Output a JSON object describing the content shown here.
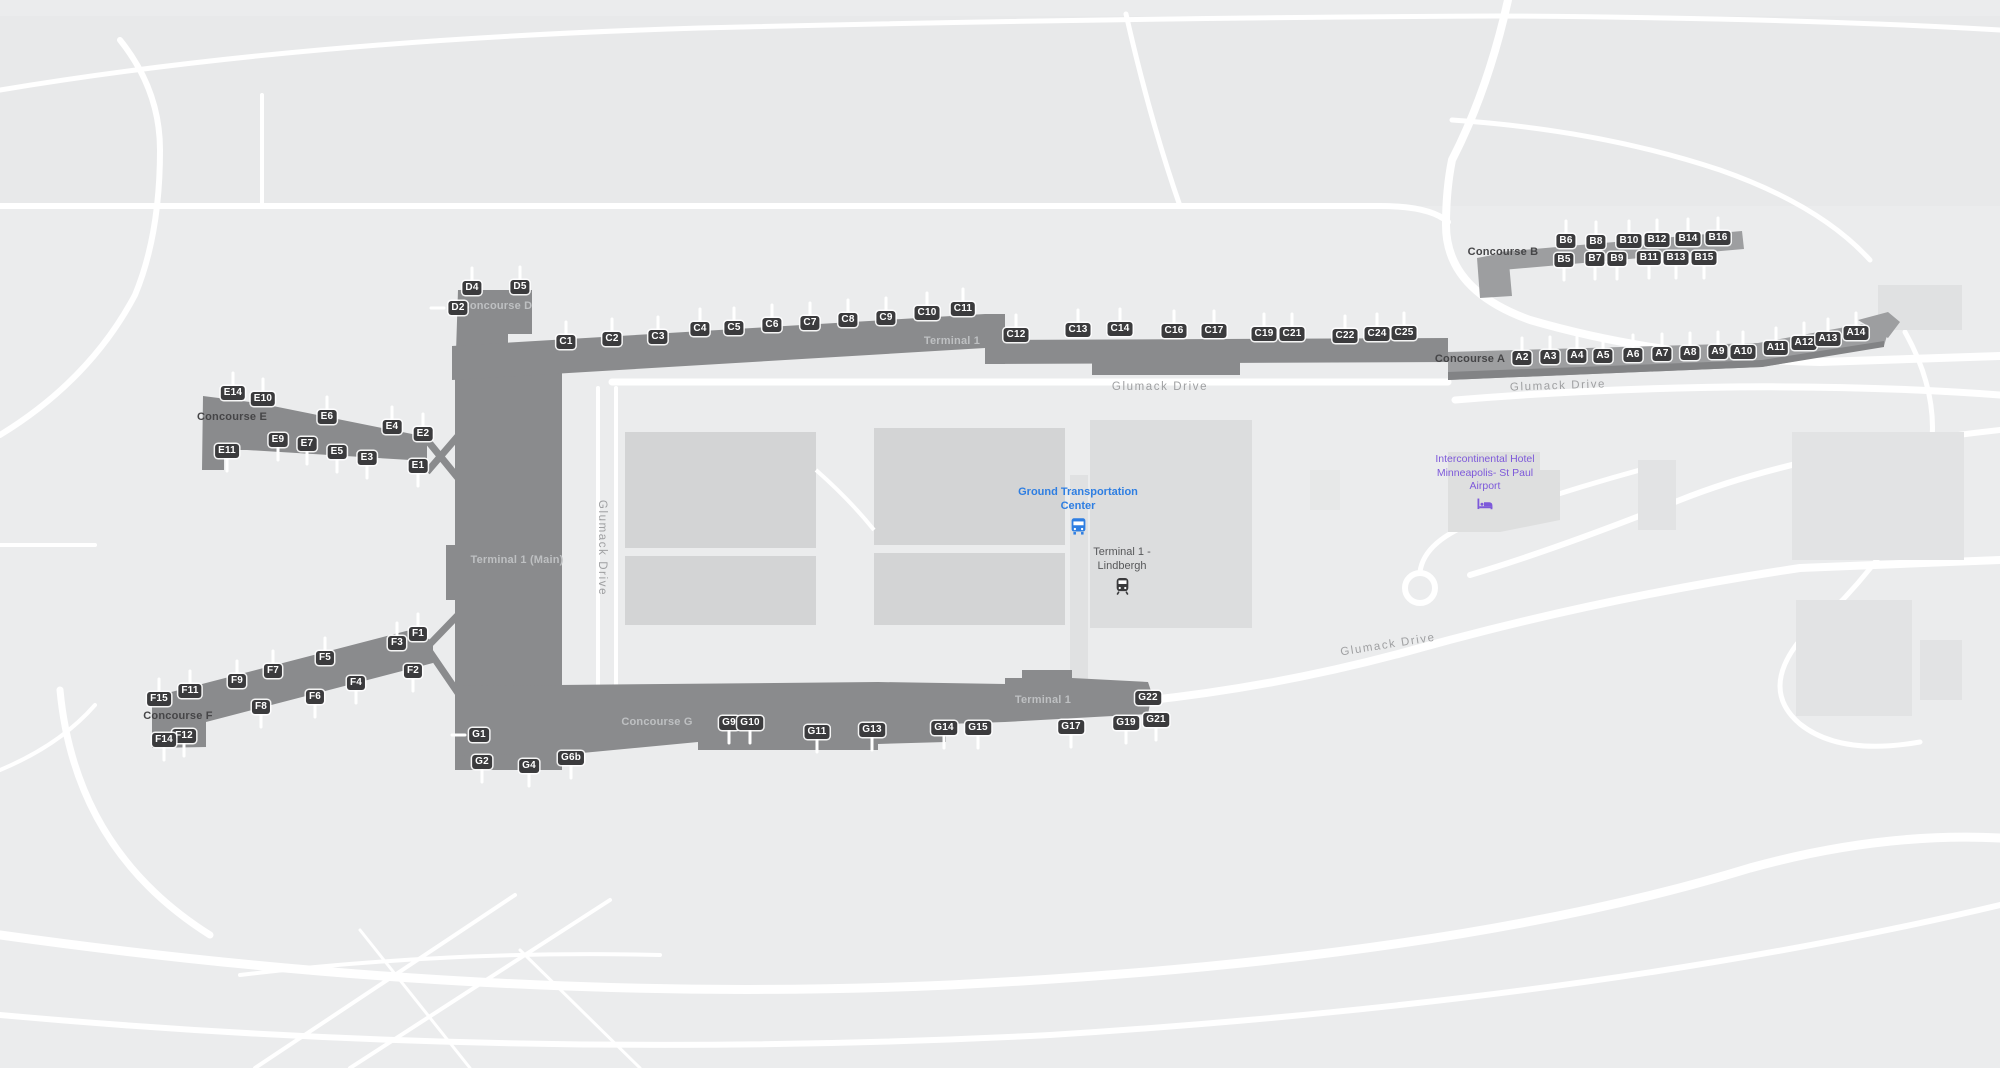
{
  "map": {
    "colors": {
      "background": "#ebeced",
      "road": "#ffffff",
      "building_dark": "#8a8b8d",
      "building_light": "#9d9ea0",
      "parking": "#d3d4d5",
      "parking_light": "#dcddde",
      "badge_bg": "#3b3b3d",
      "badge_text": "#ffffff",
      "label_dark": "#454547",
      "label_light": "#bec0c2",
      "road_label": "#9fa0a2",
      "transit_blue": "#2e7ee2",
      "hotel_purple": "#7d59da"
    }
  },
  "poi": {
    "ground_transport": "Ground Transportation Center",
    "terminal_station": "Terminal 1 - Lindbergh",
    "hotel": "Intercontinental Hotel Minneapolis- St Paul Airport"
  },
  "icons": {
    "bus": "bus-icon",
    "train": "train-icon",
    "bed": "hotel-bed-icon"
  },
  "terminal_labels": [
    {
      "text": "Terminal 1",
      "x": 952,
      "y": 341,
      "style": "light"
    },
    {
      "text": "Terminal 1 (Main)",
      "x": 517,
      "y": 560,
      "style": "light"
    },
    {
      "text": "Terminal 1",
      "x": 1043,
      "y": 700,
      "style": "light"
    }
  ],
  "road_labels": [
    {
      "text": "Glumack Drive",
      "x": 1160,
      "y": 387,
      "rot": 0
    },
    {
      "text": "Glumack Drive",
      "x": 1558,
      "y": 386,
      "rot": -2
    },
    {
      "text": "Glumack Drive",
      "x": 602,
      "y": 548,
      "rot": 90
    },
    {
      "text": "Glumack Drive",
      "x": 1388,
      "y": 645,
      "rot": -9
    }
  ],
  "concourses": [
    {
      "name": "A",
      "label": "Concourse A",
      "lx": 1470,
      "ly": 359,
      "label_style": "dark",
      "gates": [
        {
          "l": "A2",
          "x": 1522,
          "y": 358,
          "d": "u"
        },
        {
          "l": "A3",
          "x": 1550,
          "y": 357,
          "d": "u"
        },
        {
          "l": "A4",
          "x": 1577,
          "y": 356,
          "d": "u"
        },
        {
          "l": "A5",
          "x": 1603,
          "y": 356,
          "d": "u"
        },
        {
          "l": "A6",
          "x": 1633,
          "y": 355,
          "d": "u"
        },
        {
          "l": "A7",
          "x": 1662,
          "y": 354,
          "d": "u"
        },
        {
          "l": "A8",
          "x": 1690,
          "y": 353,
          "d": "u"
        },
        {
          "l": "A9",
          "x": 1718,
          "y": 352,
          "d": "u"
        },
        {
          "l": "A10",
          "x": 1743,
          "y": 352,
          "d": "u"
        },
        {
          "l": "A11",
          "x": 1776,
          "y": 348,
          "d": "u"
        },
        {
          "l": "A12",
          "x": 1804,
          "y": 343,
          "d": "u"
        },
        {
          "l": "A13",
          "x": 1828,
          "y": 339,
          "d": "u"
        },
        {
          "l": "A14",
          "x": 1856,
          "y": 333,
          "d": "u"
        }
      ]
    },
    {
      "name": "B",
      "label": "Concourse B",
      "lx": 1503,
      "ly": 252,
      "label_style": "dark",
      "gates": [
        {
          "l": "B6",
          "x": 1566,
          "y": 241,
          "d": "u"
        },
        {
          "l": "B8",
          "x": 1596,
          "y": 242,
          "d": "u"
        },
        {
          "l": "B10",
          "x": 1629,
          "y": 241,
          "d": "u"
        },
        {
          "l": "B12",
          "x": 1657,
          "y": 240,
          "d": "u"
        },
        {
          "l": "B14",
          "x": 1688,
          "y": 239,
          "d": "u"
        },
        {
          "l": "B16",
          "x": 1718,
          "y": 238,
          "d": "u"
        },
        {
          "l": "B5",
          "x": 1564,
          "y": 260,
          "d": "d"
        },
        {
          "l": "B7",
          "x": 1595,
          "y": 259,
          "d": "d"
        },
        {
          "l": "B9",
          "x": 1617,
          "y": 259,
          "d": "d"
        },
        {
          "l": "B11",
          "x": 1649,
          "y": 258,
          "d": "d"
        },
        {
          "l": "B13",
          "x": 1676,
          "y": 258,
          "d": "d"
        },
        {
          "l": "B15",
          "x": 1704,
          "y": 258,
          "d": "d"
        }
      ]
    },
    {
      "name": "C",
      "label": "",
      "lx": 0,
      "ly": 0,
      "label_style": "dark",
      "gates": [
        {
          "l": "C1",
          "x": 566,
          "y": 342,
          "d": "u"
        },
        {
          "l": "C2",
          "x": 612,
          "y": 339,
          "d": "u"
        },
        {
          "l": "C3",
          "x": 658,
          "y": 337,
          "d": "u"
        },
        {
          "l": "C4",
          "x": 700,
          "y": 329,
          "d": "u"
        },
        {
          "l": "C5",
          "x": 734,
          "y": 328,
          "d": "u"
        },
        {
          "l": "C6",
          "x": 772,
          "y": 325,
          "d": "u"
        },
        {
          "l": "C7",
          "x": 810,
          "y": 323,
          "d": "u"
        },
        {
          "l": "C8",
          "x": 848,
          "y": 320,
          "d": "u"
        },
        {
          "l": "C9",
          "x": 886,
          "y": 318,
          "d": "u"
        },
        {
          "l": "C10",
          "x": 927,
          "y": 313,
          "d": "u"
        },
        {
          "l": "C11",
          "x": 963,
          "y": 309,
          "d": "u"
        },
        {
          "l": "C12",
          "x": 1016,
          "y": 335,
          "d": "u"
        },
        {
          "l": "C13",
          "x": 1078,
          "y": 330,
          "d": "u"
        },
        {
          "l": "C14",
          "x": 1120,
          "y": 329,
          "d": "u"
        },
        {
          "l": "C16",
          "x": 1174,
          "y": 331,
          "d": "u"
        },
        {
          "l": "C17",
          "x": 1214,
          "y": 331,
          "d": "u"
        },
        {
          "l": "C19",
          "x": 1264,
          "y": 334,
          "d": "u"
        },
        {
          "l": "C21",
          "x": 1292,
          "y": 334,
          "d": "u"
        },
        {
          "l": "C22",
          "x": 1345,
          "y": 336,
          "d": "u"
        },
        {
          "l": "C24",
          "x": 1377,
          "y": 334,
          "d": "u"
        },
        {
          "l": "C25",
          "x": 1404,
          "y": 333,
          "d": "u"
        }
      ]
    },
    {
      "name": "D",
      "label": "Concourse D",
      "lx": 497,
      "ly": 306,
      "label_style": "light",
      "gates": [
        {
          "l": "D4",
          "x": 472,
          "y": 288,
          "d": "u"
        },
        {
          "l": "D5",
          "x": 520,
          "y": 287,
          "d": "u"
        },
        {
          "l": "D2",
          "x": 458,
          "y": 308,
          "d": "l"
        }
      ]
    },
    {
      "name": "E",
      "label": "Concourse E",
      "lx": 232,
      "ly": 417,
      "label_style": "dark",
      "gates": [
        {
          "l": "E14",
          "x": 233,
          "y": 393,
          "d": "u"
        },
        {
          "l": "E10",
          "x": 263,
          "y": 399,
          "d": "u"
        },
        {
          "l": "E6",
          "x": 327,
          "y": 417,
          "d": "u"
        },
        {
          "l": "E4",
          "x": 392,
          "y": 427,
          "d": "u"
        },
        {
          "l": "E2",
          "x": 423,
          "y": 434,
          "d": "u"
        },
        {
          "l": "E11",
          "x": 227,
          "y": 451,
          "d": "d"
        },
        {
          "l": "E9",
          "x": 278,
          "y": 440,
          "d": "d"
        },
        {
          "l": "E7",
          "x": 307,
          "y": 444,
          "d": "d"
        },
        {
          "l": "E5",
          "x": 337,
          "y": 452,
          "d": "d"
        },
        {
          "l": "E3",
          "x": 367,
          "y": 458,
          "d": "d"
        },
        {
          "l": "E1",
          "x": 418,
          "y": 466,
          "d": "d"
        }
      ]
    },
    {
      "name": "F",
      "label": "Concourse F",
      "lx": 178,
      "ly": 716,
      "label_style": "dark",
      "gates": [
        {
          "l": "F1",
          "x": 418,
          "y": 634,
          "d": "u"
        },
        {
          "l": "F3",
          "x": 397,
          "y": 643,
          "d": "u"
        },
        {
          "l": "F5",
          "x": 325,
          "y": 658,
          "d": "u"
        },
        {
          "l": "F7",
          "x": 273,
          "y": 671,
          "d": "u"
        },
        {
          "l": "F9",
          "x": 237,
          "y": 681,
          "d": "u"
        },
        {
          "l": "F11",
          "x": 190,
          "y": 691,
          "d": "u"
        },
        {
          "l": "F15",
          "x": 159,
          "y": 699,
          "d": "u"
        },
        {
          "l": "F2",
          "x": 413,
          "y": 671,
          "d": "d"
        },
        {
          "l": "F4",
          "x": 356,
          "y": 683,
          "d": "d"
        },
        {
          "l": "F6",
          "x": 315,
          "y": 697,
          "d": "d"
        },
        {
          "l": "F8",
          "x": 261,
          "y": 707,
          "d": "d"
        },
        {
          "l": "F12",
          "x": 184,
          "y": 736,
          "d": "d"
        },
        {
          "l": "F14",
          "x": 164,
          "y": 740,
          "d": "d"
        }
      ]
    },
    {
      "name": "G",
      "label": "Concourse G",
      "lx": 657,
      "ly": 722,
      "label_style": "light",
      "gates": [
        {
          "l": "G1",
          "x": 479,
          "y": 735,
          "d": "l"
        },
        {
          "l": "G2",
          "x": 482,
          "y": 762,
          "d": "d"
        },
        {
          "l": "G4",
          "x": 529,
          "y": 766,
          "d": "d"
        },
        {
          "l": "G6b",
          "x": 571,
          "y": 758,
          "d": "d"
        },
        {
          "l": "G9",
          "x": 729,
          "y": 723,
          "d": "d"
        },
        {
          "l": "G10",
          "x": 750,
          "y": 723,
          "d": "d"
        },
        {
          "l": "G11",
          "x": 817,
          "y": 732,
          "d": "d"
        },
        {
          "l": "G13",
          "x": 872,
          "y": 730,
          "d": "d"
        },
        {
          "l": "G14",
          "x": 944,
          "y": 728,
          "d": "d"
        },
        {
          "l": "G15",
          "x": 978,
          "y": 728,
          "d": "d"
        },
        {
          "l": "G17",
          "x": 1071,
          "y": 727,
          "d": "d"
        },
        {
          "l": "G19",
          "x": 1126,
          "y": 723,
          "d": "d"
        },
        {
          "l": "G21",
          "x": 1156,
          "y": 720,
          "d": "d"
        },
        {
          "l": "G22",
          "x": 1148,
          "y": 698,
          "d": "r"
        }
      ]
    }
  ]
}
